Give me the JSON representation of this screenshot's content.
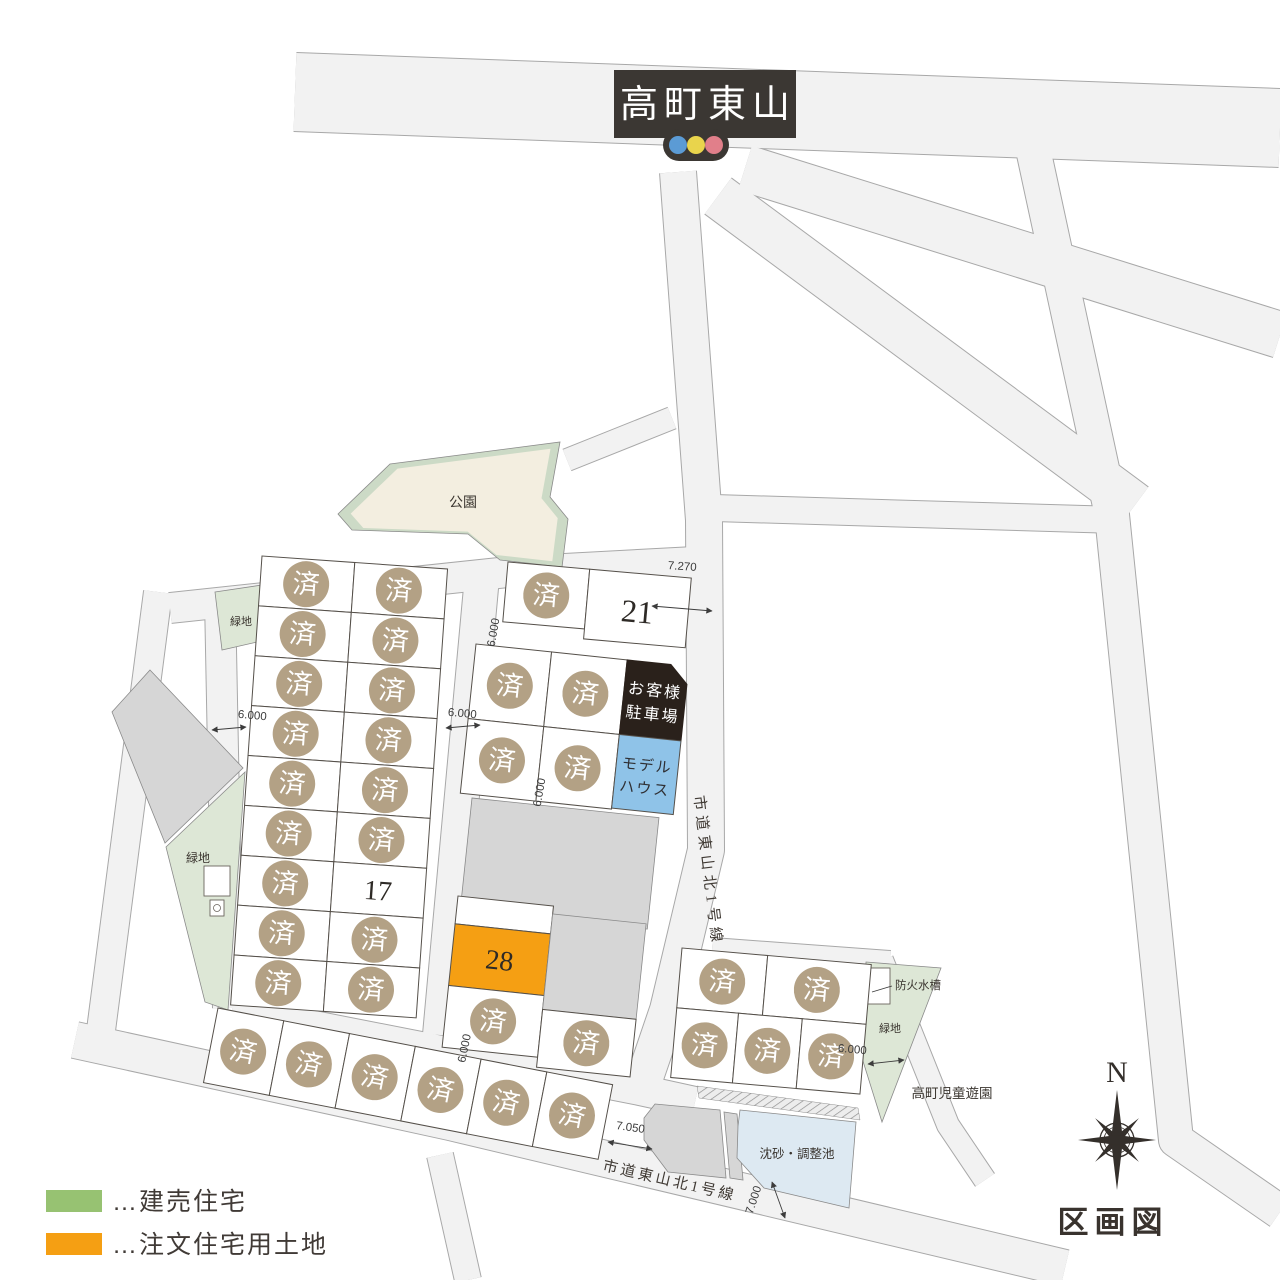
{
  "sign": {
    "title": "高町東山"
  },
  "map_title": "区画図",
  "compass": {
    "north": "N"
  },
  "labels": {
    "sold": "済",
    "park": "公園",
    "green_area": "緑地",
    "fire_tank": "防火水槽",
    "children_park": "高町児童遊園",
    "pond": "沈砂・調整池",
    "parking_line1": "お客様",
    "parking_line2": "駐車場",
    "model_line1": "モデル",
    "model_line2": "ハウス",
    "road_vertical": "市道東山北1号線",
    "road_bottom": "市道東山北1号線"
  },
  "lots": {
    "for_sale_built": {
      "number": "17"
    },
    "open": {
      "number": "21"
    },
    "custom_land": {
      "number": "28"
    }
  },
  "dims": {
    "d7270": "7.270",
    "d6000": "6.000",
    "d7050": "7.050",
    "d7000": "7.000"
  },
  "legend": {
    "items": [
      {
        "label": "…建売住宅",
        "color": "#97c272"
      },
      {
        "label": "…注文住宅用土地",
        "color": "#f59f13"
      }
    ]
  },
  "colors": {
    "road_fill": "#f2f2f2",
    "road_edge": "#a8a8a8",
    "lot_edge": "#55504a",
    "sold_badge": "#b3a185",
    "for_sale_green": "#97c272",
    "custom_orange": "#f59f13",
    "parking_bg": "#2a211b",
    "model_blue": "#8fc3e8",
    "park_fill": "#f3eee0",
    "park_band": "#ccdac6",
    "green_fill": "#dde7d6",
    "gray_fill": "#d6d6d6",
    "pond_fill": "#dde9f2",
    "sign_bg": "#3b3733",
    "signal_blue": "#5b9bd5",
    "signal_yellow": "#e9d44c",
    "signal_red": "#e17f8a",
    "ink": "#342f2b"
  }
}
